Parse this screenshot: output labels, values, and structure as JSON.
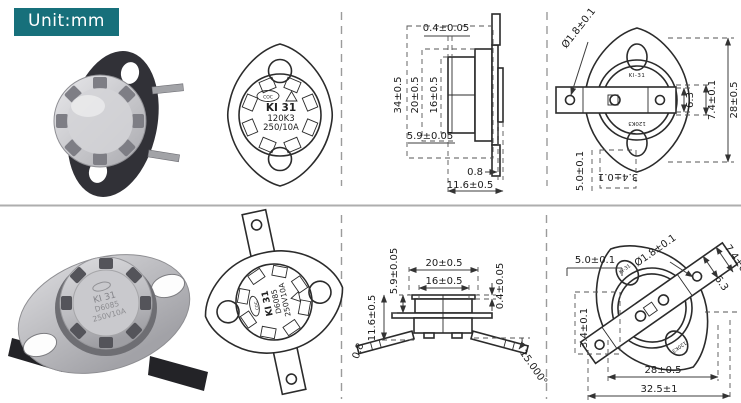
{
  "unit_label": "Unit:mm",
  "colors": {
    "badge_bg": "#17707b",
    "badge_text": "#ffffff",
    "drawing_line": "#2b2b2b",
    "divider": "#9b9b9b"
  },
  "front_view_marking": {
    "logo": "COC",
    "model": "KI 31",
    "code": "120K3",
    "rating": "250/10A"
  },
  "bottom_marking": {
    "logo": "COC",
    "model": "KI 31",
    "code": "D6085",
    "rating": "250V10A"
  },
  "rear_marking": {
    "model": "KI-31",
    "code": "120K3"
  },
  "dims": {
    "top_side": {
      "cap_disc": "0.4±0.05",
      "total_h": "34±0.5",
      "body_h": "20±0.5",
      "cap_h": "16±0.5",
      "step": "5.9±0.05",
      "plate": "0.8",
      "depth": "11.6±0.5"
    },
    "top_rear": {
      "hole_dia": "Ø1.8±0.1",
      "term_w": "6.3",
      "term_h": "7.4±0.1",
      "flange_len": "28±0.5",
      "ear": "5.0±0.1",
      "ear_w": "3.4±0.1"
    },
    "bottom_side": {
      "step": "5.9±0.05",
      "body_w": "20±0.5",
      "cap_w": "16±0.5",
      "cap_disc": "0.4±0.05",
      "depth": "11.6±0.5",
      "plate": "0.8",
      "lead_angle": "15.000°"
    },
    "bottom_rear": {
      "hole_dia": "Ø1.8±0.1",
      "term_h": "7.4±0.1",
      "term_w": "6.3",
      "ear": "5.0±0.1",
      "ear_w": "3.4±0.1",
      "hole_span": "28±0.5",
      "flange_len": "32.5±1"
    }
  }
}
